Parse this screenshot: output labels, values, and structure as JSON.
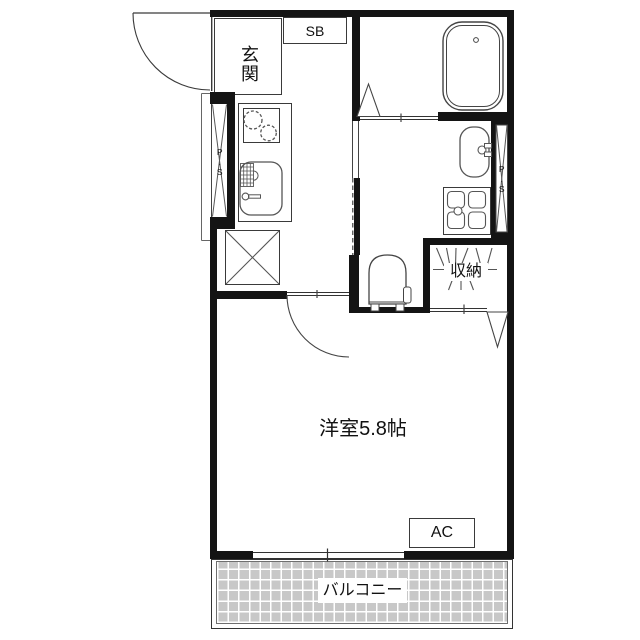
{
  "plan": {
    "type": "japanese-apartment-floor-plan",
    "labels": {
      "entrance": "玄関",
      "shoe_box": "SB",
      "pipe_space_left": "P.S",
      "pipe_space_right": "P.S",
      "closet": "収納",
      "main_room": "洋室5.8帖",
      "air_conditioner": "AC",
      "balcony": "バルコニー"
    },
    "rooms": [
      {
        "name": "entrance-genkan",
        "label": "玄関"
      },
      {
        "name": "kitchen-corridor",
        "label": ""
      },
      {
        "name": "bathroom",
        "label": ""
      },
      {
        "name": "washroom-toilet",
        "label": ""
      },
      {
        "name": "closet",
        "label": "収納"
      },
      {
        "name": "western-room",
        "label": "洋室5.8帖",
        "size_tatami": "5.8帖"
      },
      {
        "name": "balcony",
        "label": "バルコニー"
      }
    ],
    "fixtures": [
      "entrance-swing-door",
      "shoe-box",
      "pipe-shaft-left",
      "gas-stove-two-burners",
      "kitchen-sink",
      "refrigerator-space",
      "bathtub",
      "bath-folding-door",
      "washbasin",
      "washing-machine-pan",
      "pipe-shaft-right",
      "toilet",
      "closet-hanger-pipe",
      "closet-folding-door",
      "room-swing-door",
      "air-conditioner-box",
      "balcony-sliding-window"
    ],
    "colors": {
      "wall": "#141414",
      "thin_line": "#3a3a3a",
      "balcony_tile": "#c8c8c8",
      "background": "#ffffff"
    }
  }
}
